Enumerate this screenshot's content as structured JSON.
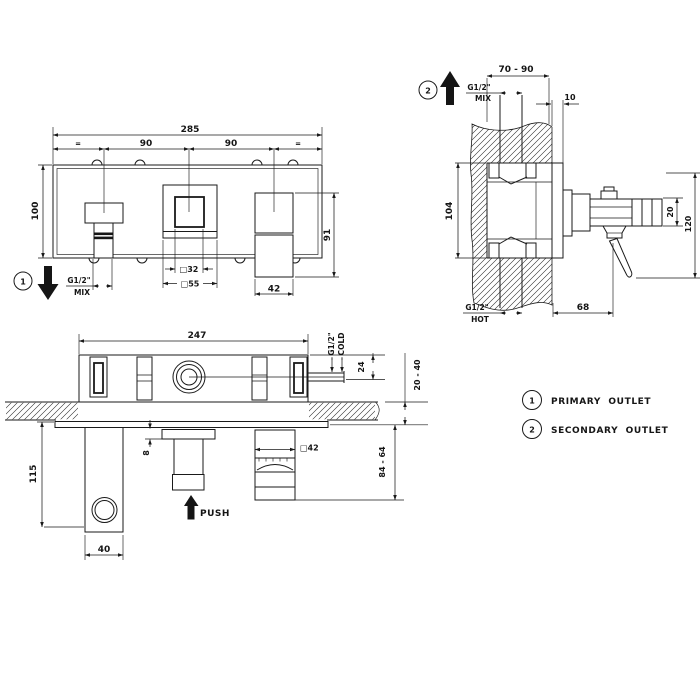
{
  "colors": {
    "line": "#1a1a1a",
    "background": "#ffffff"
  },
  "front_view": {
    "callout": "1",
    "dim_total": "285",
    "eq_left": "=",
    "dim_span_left": "90",
    "dim_span_right": "90",
    "eq_right": "=",
    "dim_height": "100",
    "dim_handle_height": "91",
    "dim_square_inner": "□32",
    "dim_square_outer": "□55",
    "dim_spout_width": "42",
    "thread": "G1/2\"",
    "thread_type": "MIX"
  },
  "section_view": {
    "callout": "2",
    "dim_depth_range": "70 - 90",
    "dim_plate_thickness": "10",
    "dim_body_height": "104",
    "mix_thread": "G1/2\"",
    "mix_label": "MIX",
    "hot_thread": "G1/2\"",
    "hot_label": "HOT",
    "dim_spout_size": "20",
    "dim_overall_height": "120",
    "dim_projection": "68"
  },
  "plan_view": {
    "dim_total": "247",
    "cold_thread": "G1/2\"",
    "cold_label": "COLD",
    "dim_cold_offset": "24",
    "dim_wall_depth_range": "20 - 40",
    "dim_flange_gap": "8",
    "dim_knob_square": "□42",
    "dim_knob_depth_range": "84 - 64",
    "dim_holder_height": "115",
    "dim_holder_width": "40",
    "push_label": "PUSH"
  },
  "legend": {
    "item1_num": "1",
    "item1_label": "PRIMARY  OUTLET",
    "item2_num": "2",
    "item2_label": "SECONDARY  OUTLET"
  }
}
